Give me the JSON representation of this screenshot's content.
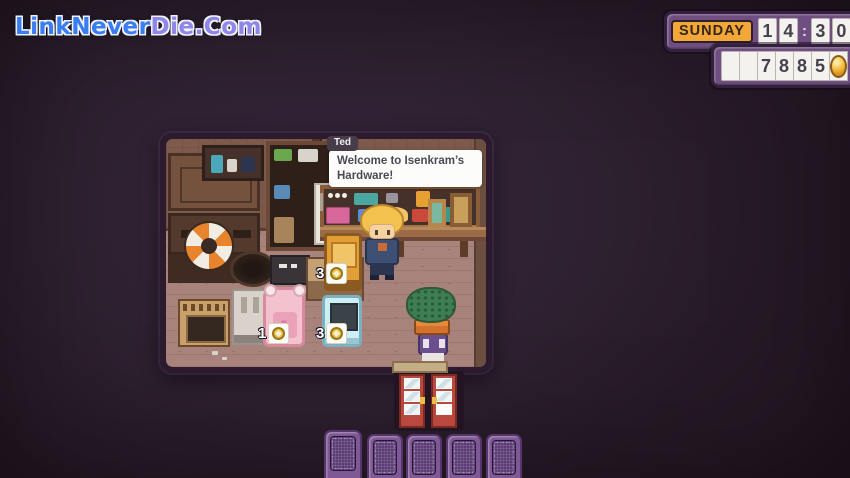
{
  "watermark": {
    "part1": "LinkNever",
    "part2": "Die.Com",
    "full_text": "LinkNeverDie.Com"
  },
  "hud": {
    "day": "SUNDAY",
    "time": {
      "digits": [
        "1",
        "4",
        "3",
        "0"
      ],
      "separator": ":"
    },
    "money": {
      "cells": [
        "",
        "",
        "7",
        "8",
        "8",
        "5"
      ],
      "currency_icon": "gold-coin"
    }
  },
  "dialog": {
    "speaker": "Ted",
    "lines": [
      "Welcome to Isenkram’s",
      "Hardware!"
    ]
  },
  "shop_items": [
    {
      "name": "arcade-machine",
      "price": "3",
      "price_icon": "gold-coin"
    },
    {
      "name": "plush-bear-seat",
      "price": "1",
      "price_icon": "gold-coin"
    },
    {
      "name": "retro-tv",
      "price": "3",
      "price_icon": "gold-coin"
    }
  ],
  "hotbar": {
    "slot_count": 5,
    "selected_slot": 1
  },
  "colors": {
    "hud_panel": "#6f4f82",
    "hud_day_bg": "#f2a738",
    "floor": "#a8837c",
    "wall": "#7d5a4a",
    "room_border": "#2c1b2f",
    "hotbar_slot": "#7e5996",
    "coin": "#e8b83a",
    "watermark_blue": "#3a7df0",
    "watermark_purple": "#8f86e8"
  }
}
